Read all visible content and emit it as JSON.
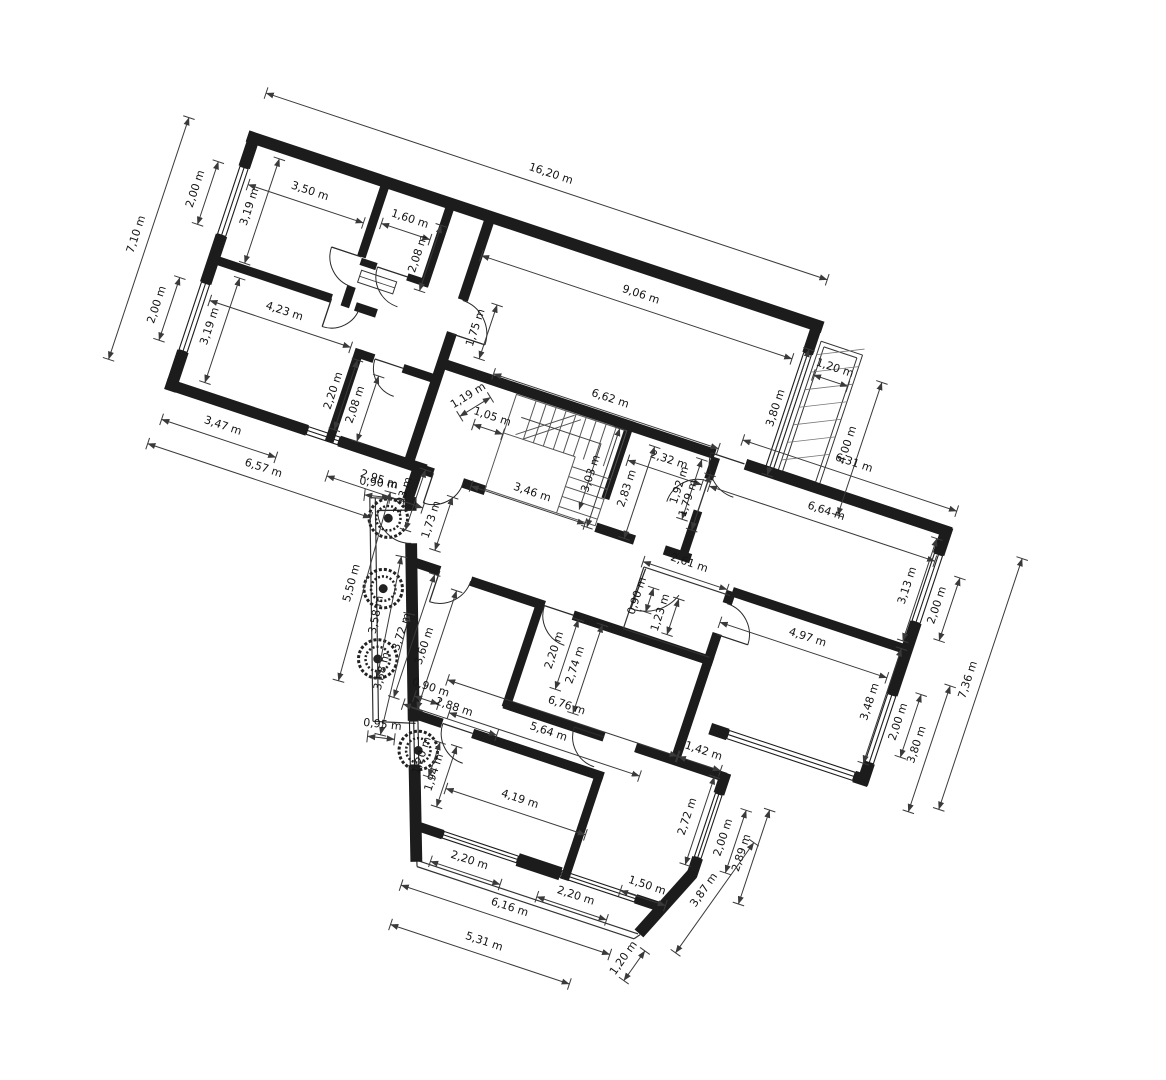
{
  "meta": {
    "drawing_type": "architectural floor plan",
    "units": "m",
    "rotation_deg": 18.4,
    "scale_px_per_m": 37,
    "origin_px": [
      250,
      131
    ]
  },
  "colors": {
    "background": "#ffffff",
    "wall": "#1c1c1c",
    "dimension_line": "#3a3a3a",
    "label_text": "#141414"
  },
  "dimensions": [
    {
      "t": "7,10 m",
      "u": -1.95,
      "v": 3.62,
      "r": -90,
      "l": 7.1
    },
    {
      "t": "2,00 m",
      "u": -0.82,
      "v": 1.95,
      "r": -90,
      "l": 2.0
    },
    {
      "t": "3,19 m",
      "u": 0.72,
      "v": 1.95,
      "r": -90,
      "l": 3.19
    },
    {
      "t": "2,00 m",
      "u": -0.82,
      "v": 5.25,
      "r": -90,
      "l": 2.0
    },
    {
      "t": "3,19 m",
      "u": 0.72,
      "v": 5.35,
      "r": -90,
      "l": 3.19
    },
    {
      "t": "3,50 m",
      "u": 2.05,
      "v": 1.12,
      "r": 0,
      "l": 3.5
    },
    {
      "t": "1,60 m",
      "u": 4.85,
      "v": 0.98,
      "r": 0,
      "l": 1.6
    },
    {
      "t": "2,08 m",
      "u": 5.44,
      "v": 1.72,
      "r": -90,
      "l": 2.08
    },
    {
      "t": "4,23 m",
      "u": 2.42,
      "v": 4.42,
      "r": 0,
      "l": 4.23
    },
    {
      "t": "2,20 m",
      "u": 4.44,
      "v": 5.95,
      "r": -90,
      "l": 2.2
    },
    {
      "t": "2,08 m",
      "u": 5.12,
      "v": 6.12,
      "r": -90,
      "l": 2.08
    },
    {
      "t": "3,47 m",
      "u": 1.82,
      "v": 7.88,
      "r": 0,
      "l": 3.47
    },
    {
      "t": "6,57 m",
      "u": 3.22,
      "v": 8.62,
      "r": 0,
      "l": 6.57
    },
    {
      "t": "2,95 m",
      "u": 6.28,
      "v": 7.92,
      "r": 0,
      "l": 2.95
    },
    {
      "t": "16,20 m",
      "u": 8.08,
      "v": -1.38,
      "r": 0,
      "l": 16.2
    },
    {
      "t": "9,06 m",
      "u": 11.42,
      "v": 0.95,
      "r": 0,
      "l": 9.06
    },
    {
      "t": "3,80 m",
      "u": 15.93,
      "v": 2.62,
      "r": -90,
      "l": 3.8
    },
    {
      "t": "1,20 m",
      "u": 17.02,
      "v": 1.18,
      "r": 0,
      "l": 1.2
    },
    {
      "t": "4,00 m",
      "u": 18.08,
      "v": 2.95,
      "r": -90,
      "l": 4.0
    },
    {
      "t": "6,62 m",
      "u": 11.52,
      "v": 3.88,
      "r": 0,
      "l": 6.62
    },
    {
      "t": "1,75 m",
      "u": 7.55,
      "v": 3.12,
      "r": -90,
      "l": 1.75
    },
    {
      "t": "1,19 m",
      "u": 7.92,
      "v": 4.98,
      "r": -50,
      "l": 1.19
    },
    {
      "t": "1,05 m",
      "u": 8.65,
      "v": 5.35,
      "r": 0,
      "l": 1.05
    },
    {
      "t": "3,03 m",
      "u": 11.75,
      "v": 5.88,
      "r": -90,
      "l": 3.03
    },
    {
      "t": "3,46 m",
      "u": 10.32,
      "v": 6.95,
      "r": 0,
      "l": 3.46
    },
    {
      "t": "2,32 m",
      "u": 13.55,
      "v": 4.95,
      "r": 0,
      "l": 2.32
    },
    {
      "t": "2,83 m",
      "u": 12.8,
      "v": 5.95,
      "r": -90,
      "l": 2.83
    },
    {
      "t": "1,92 m",
      "u": 14.12,
      "v": 5.42,
      "r": -90,
      "l": 1.92
    },
    {
      "t": "1,79 m",
      "u": 14.46,
      "v": 5.68,
      "r": -90,
      "l": 1.79
    },
    {
      "t": "6,31 m",
      "u": 18.32,
      "v": 3.45,
      "r": 0,
      "l": 6.31
    },
    {
      "t": "6,64 m",
      "u": 18.02,
      "v": 4.92,
      "r": 0,
      "l": 6.64
    },
    {
      "t": "2,61 m",
      "u": 14.95,
      "v": 7.42,
      "r": 0,
      "l": 2.61
    },
    {
      "t": "0,90 m",
      "u": 13.98,
      "v": 8.62,
      "r": -90,
      "l": 0.9
    },
    {
      "t": "1,23 m",
      "u": 14.72,
      "v": 8.85,
      "r": -90,
      "l": 1.23
    },
    {
      "t": "4,97 m",
      "u": 18.62,
      "v": 8.32,
      "r": 0,
      "l": 4.97
    },
    {
      "t": "3,13 m",
      "u": 20.82,
      "v": 6.05,
      "r": -90,
      "l": 3.13
    },
    {
      "t": "2,00 m",
      "u": 21.75,
      "v": 6.3,
      "r": -90,
      "l": 2.0
    },
    {
      "t": "3,48 m",
      "u": 20.85,
      "v": 9.35,
      "r": -90,
      "l": 3.48
    },
    {
      "t": "2,00 m",
      "u": 21.75,
      "v": 9.62,
      "r": -90,
      "l": 2.0
    },
    {
      "t": "3,80 m",
      "u": 22.42,
      "v": 10.05,
      "r": -90,
      "l": 3.8
    },
    {
      "t": "7,36 m",
      "u": 23.18,
      "v": 7.95,
      "r": -90,
      "l": 7.36
    },
    {
      "t": "1,93 m",
      "u": 7.12,
      "v": 8.05,
      "r": -90,
      "l": 1.93
    },
    {
      "t": "1,73 m",
      "u": 8.05,
      "v": 8.42,
      "r": -90,
      "l": 1.73
    },
    {
      "t": "0,90 m",
      "u": 6.32,
      "v": 8.02,
      "r": -12,
      "l": 0.9
    },
    {
      "t": "5,50 m",
      "u": 6.55,
      "v": 10.72,
      "r": -93,
      "l": 5.5
    },
    {
      "t": "3,58 m",
      "u": 7.45,
      "v": 11.32,
      "r": -97,
      "l": 3.58
    },
    {
      "t": "3,58 m",
      "u": 8.08,
      "v": 12.72,
      "r": -95,
      "l": 3.58
    },
    {
      "t": "3,72 m",
      "u": 8.25,
      "v": 11.55,
      "r": -90,
      "l": 3.72
    },
    {
      "t": "3,60 m",
      "u": 8.95,
      "v": 11.72,
      "r": -90,
      "l": 3.6
    },
    {
      "t": "2,20 m",
      "u": 12.32,
      "v": 10.72,
      "r": -90,
      "l": 2.2
    },
    {
      "t": "2,74 m",
      "u": 12.98,
      "v": 10.92,
      "r": -90,
      "l": 2.74
    },
    {
      "t": "0,90 m",
      "u": 9.38,
      "v": 12.82,
      "r": 0,
      "l": 0.9
    },
    {
      "t": "2,88 m",
      "u": 10.15,
      "v": 13.12,
      "r": 0,
      "l": 2.88
    },
    {
      "t": "6,76 m",
      "u": 13.02,
      "v": 12.12,
      "r": 0,
      "l": 6.76
    },
    {
      "t": "5,64 m",
      "u": 12.78,
      "v": 12.95,
      "r": 0,
      "l": 5.64
    },
    {
      "t": "1,42 m",
      "u": 16.92,
      "v": 12.12,
      "r": 0,
      "l": 1.42
    },
    {
      "t": "1,94 m",
      "u": 10.28,
      "v": 14.88,
      "r": -90,
      "l": 1.94
    },
    {
      "t": "4,19 m",
      "u": 12.62,
      "v": 14.92,
      "r": 0,
      "l": 4.19
    },
    {
      "t": "1,20 m",
      "u": 9.82,
      "v": 14.55,
      "r": -90,
      "l": 1.2
    },
    {
      "t": "0,95 m",
      "u": 8.48,
      "v": 14.18,
      "r": -12,
      "l": 0.95
    },
    {
      "t": "2,72 m",
      "u": 17.15,
      "v": 13.85,
      "r": -90,
      "l": 2.72
    },
    {
      "t": "2,00 m",
      "u": 18.25,
      "v": 14.08,
      "r": -90,
      "l": 2.0
    },
    {
      "t": "2,89 m",
      "u": 18.85,
      "v": 14.32,
      "r": -90,
      "l": 2.89
    },
    {
      "t": "1,50 m",
      "u": 16.62,
      "v": 16.05,
      "r": 0,
      "l": 1.5
    },
    {
      "t": "3,87 m",
      "u": 18.2,
      "v": 15.62,
      "r": -73,
      "l": 3.87
    },
    {
      "t": "1,20 m",
      "u": 16.72,
      "v": 18.05,
      "r": -73,
      "l": 1.2
    },
    {
      "t": "2,20 m",
      "u": 11.85,
      "v": 16.92,
      "r": 0,
      "l": 2.2
    },
    {
      "t": "2,20 m",
      "u": 14.88,
      "v": 16.92,
      "r": 0,
      "l": 2.2
    },
    {
      "t": "6,16 m",
      "u": 13.28,
      "v": 17.78,
      "r": 0,
      "l": 6.16
    },
    {
      "t": "5,31 m",
      "u": 12.92,
      "v": 18.88,
      "r": 0,
      "l": 5.31
    }
  ]
}
